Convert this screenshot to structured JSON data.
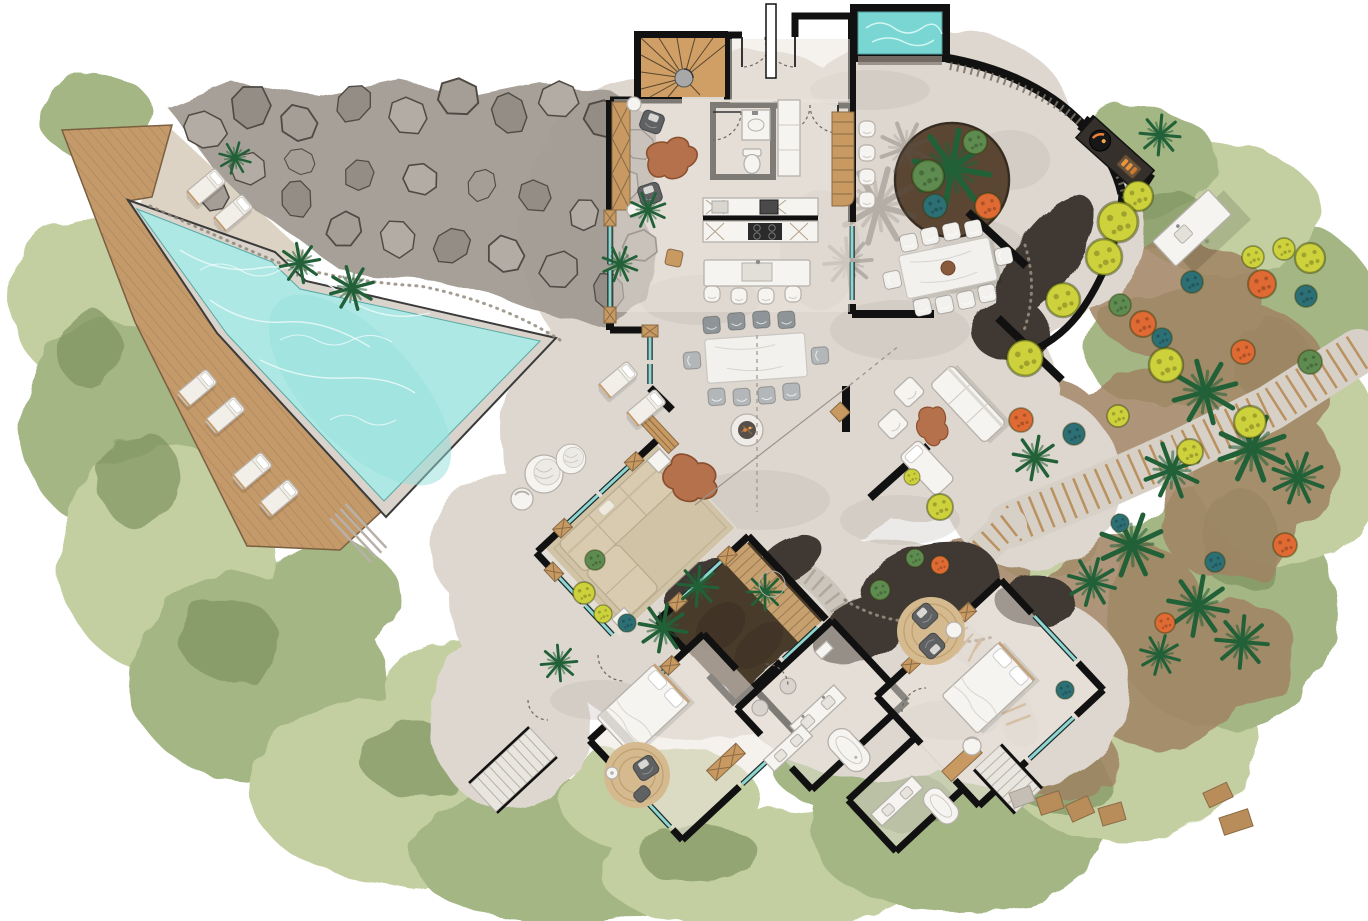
{
  "plan": {
    "title": "Tropical villa floor plan",
    "style": "hand-rendered watercolor site plan, top-down view, no text labels",
    "outdoor": {
      "main_pool": {
        "shape": "triangular pool with turquoise water, tiled coping and contour ripples",
        "notch_palms": 2
      },
      "timber_deck": {
        "description": "diagonal-plank sun deck along west side of pool",
        "loungers_on_deck": 4,
        "loungers_upper_terrace": 2,
        "steps": true
      },
      "rock_garden": {
        "description": "gray boulder field along north edge of pool",
        "boulders": "many"
      },
      "pool_terrace": {
        "loungers": 2,
        "hanging_egg_chairs": 2,
        "small_chair": 1,
        "fire_bowl": 1,
        "driftwood_tables": 2
      },
      "plunge_pool": {
        "location": "north entry court",
        "shape": "rectangular"
      },
      "entry_court": {
        "circular_planter": {
          "palm": 1,
          "shrubs": 3,
          "orange_flower": 1
        },
        "bar_counter_seats": 4,
        "bbq_counter": "dark grill counter with fire and tray",
        "outdoor_island": "white prep island with sink",
        "palm_shadows": true
      },
      "outdoor_dining": {
        "seats": 10,
        "table": "white stone slab with centerpiece bowl"
      },
      "outdoor_lounge": {
        "sofa": 1,
        "chaise": 1,
        "armchairs": 2,
        "live_edge_table": 1,
        "privacy_walls": 3,
        "side_cube_table": 1
      },
      "garden": {
        "stepped_timber_paths": 2,
        "gray_garden_steps": 1,
        "palms": 18,
        "yellow_ball_shrubs": 16,
        "orange_flower_shrubs": 8,
        "teal_shrubs": 9,
        "lava_mulch_beds": 5,
        "stepping_stones": 6,
        "timber_pads": 2
      },
      "exterior_stairs": 2
    },
    "indoor": {
      "spiral_staircase": "timber-tread spiral stair room, top-left of entry",
      "entry": "double doors with dashed swing arcs and canopy line",
      "powder_room": {
        "wc": 1,
        "basin_counter": 1
      },
      "tall_cabinet": 1,
      "lounge_nook": {
        "armchairs": 2,
        "driftwood_table": 1,
        "wall_bench": 1,
        "side_tables": 2,
        "pouf": 1
      },
      "kitchen": {
        "back_counter": "cabinets with cooktop and appliances",
        "island": "sink island",
        "island_stools": 4,
        "bar_counter": "timber counter to court"
      },
      "covered_dining": {
        "seats": 10,
        "table": "stone slab"
      },
      "living_pavilion": {
        "area_rug": 1,
        "sectional_sofa": 1,
        "side_tables": 2,
        "driftwood_coffee_table": 1,
        "bench": 1
      },
      "internal_courtyard": {
        "palms": 3,
        "soil_bed": true,
        "timber_walkway": true,
        "round_stepping_stone": 1
      },
      "master_bedroom": {
        "bed": 1,
        "round_jute_rug": 1,
        "armchair": 1,
        "ottoman": 1,
        "floor_lamp": 1,
        "console": 1
      },
      "master_bathroom": {
        "vanities": 2,
        "freestanding_tub": 1,
        "stools": 2,
        "shelf": 1
      },
      "guest_bathroom": {
        "vanity": 1,
        "tub": 1
      },
      "guest_bedroom": {
        "bed": 1,
        "round_jute_rug": 1,
        "armchairs": 2,
        "side_table": 1,
        "desk": 1,
        "desk_chair": 1
      }
    },
    "graphics": {
      "walls": "thick black poché",
      "glazing": "teal sliding panels",
      "door_swings": "dashed arcs",
      "roof_overhang": "thin dashed lines",
      "shadows": "soft gray washes"
    }
  },
  "palette": {
    "veg_light": "#c3cfa0",
    "veg_mid": "#a4b684",
    "veg_dark": "#87a065",
    "veg_accent": "#7d9360",
    "earth": "#a08363",
    "lava_mulch": "#3f3933",
    "rock_light": "#b3aca4",
    "rock_mid": "#a29b93",
    "rock_dark": "#948d85",
    "rock_stroke": "#4f4a44",
    "deck_wood": "#c49a6a",
    "deck_line": "#8a6b47",
    "pool_water": "#aee8e4",
    "pool_contour": "#e9faf8",
    "pool_coping": "#d9d3cb",
    "plunge_water": "#79d6d3",
    "concrete": "#ddd7cf",
    "concrete_interior": "#ece6de",
    "sand": "#ddd3c4",
    "shadow_wash": "#b9b3ac",
    "wall": "#111111",
    "glass": "#8fd6d2",
    "door_wood": "#c89a62",
    "white_furniture": "#f6f4f1",
    "furniture_stroke": "#b5b0a9",
    "gray_chair": "#9aa0a3",
    "dark_chair": "#5f6163",
    "sofa_beige": "#d8cbb0",
    "rug_beige": "#d0c3a6",
    "rug_jute": "#d4ba8e",
    "marble": "#f2f1ee",
    "driftwood": "#b5714b",
    "fire_orange": "#e8833c",
    "courtyard_soil": "#4a3b2c",
    "walkway_wood": "#c7a06f",
    "palm_green": "#226038",
    "shrub_yellow": "#ccd13c",
    "shrub_orange": "#e06a33",
    "shrub_teal": "#2c6f75",
    "path_stone": "#d6d0c7",
    "step_wood": "#b98d5a"
  }
}
